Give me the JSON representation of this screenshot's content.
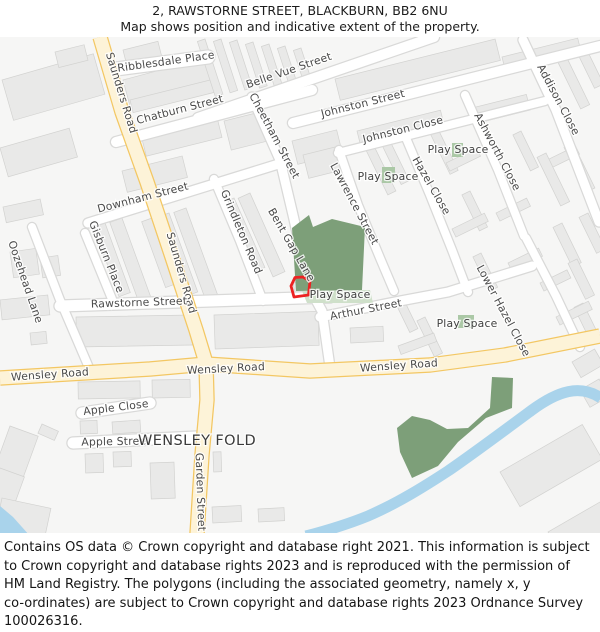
{
  "header": {
    "line1": "2, RAWSTORNE STREET, BLACKBURN, BB2 6NU",
    "line2": "Map shows position and indicative extent of the property."
  },
  "map": {
    "street_labels": [
      {
        "id": "ribblesdale-place",
        "text": "Ribblesdale Place"
      },
      {
        "id": "saunders-road-top",
        "text": "Saunders Road"
      },
      {
        "id": "chatburn-street",
        "text": "Chatburn Street"
      },
      {
        "id": "belle-vue-street",
        "text": "Belle Vue Street"
      },
      {
        "id": "cheetham-street",
        "text": "Cheetham Street"
      },
      {
        "id": "johnston-street",
        "text": "Johnston Street"
      },
      {
        "id": "johnston-close",
        "text": "Johnston Close"
      },
      {
        "id": "addison-close",
        "text": "Addison Close"
      },
      {
        "id": "ashworth-close",
        "text": "Ashworth Close"
      },
      {
        "id": "hazel-close",
        "text": "Hazel Close"
      },
      {
        "id": "play-space-ne",
        "text": "Play Space"
      },
      {
        "id": "play-space-n",
        "text": "Play Space"
      },
      {
        "id": "lawrence-street",
        "text": "Lawrence Street"
      },
      {
        "id": "downham-street",
        "text": "Downham Street"
      },
      {
        "id": "gisburn-place",
        "text": "Gisburn Place"
      },
      {
        "id": "oozehead-lane",
        "text": "Oozehead Lane"
      },
      {
        "id": "saunders-road-mid",
        "text": "Saunders Road"
      },
      {
        "id": "grindleton-road",
        "text": "Grindleton Road"
      },
      {
        "id": "bent-gap-lane",
        "text": "Bent Gap Lane"
      },
      {
        "id": "rawstorne-street",
        "text": "Rawstorne Street"
      },
      {
        "id": "play-space-central",
        "text": "Play Space"
      },
      {
        "id": "arthur-street",
        "text": "Arthur Street"
      },
      {
        "id": "lower-hazel-close",
        "text": "Lower Hazel Close"
      },
      {
        "id": "play-space-se",
        "text": "Play Space"
      },
      {
        "id": "wensley-road-left",
        "text": "Wensley Road"
      },
      {
        "id": "wensley-road-mid",
        "text": "Wensley Road"
      },
      {
        "id": "wensley-road-right",
        "text": "Wensley Road"
      },
      {
        "id": "apple-close",
        "text": "Apple Close"
      },
      {
        "id": "apple-street",
        "text": "Apple Street"
      },
      {
        "id": "wensley-fold-area",
        "text": "WENSLEY FOLD"
      },
      {
        "id": "garden-street",
        "text": "Garden Street"
      }
    ],
    "colors": {
      "background": "#f6f6f5",
      "building": "#e9e9e8",
      "building_border": "#d2d2d0",
      "road_minor": "#ffffff",
      "road_minor_casing": "#d9d9d8",
      "road_major": "#fdf3d8",
      "road_major_casing": "#f3c763",
      "green_space": "#7d9f79",
      "green_light": "#cfe0ca",
      "green_patch": "#abc8a6",
      "water": "#a9d3eb",
      "property_outline": "#ec2222",
      "label_text": "#4a4a4a"
    }
  },
  "footer": {
    "lines": [
      "Contains OS data © Crown copyright and database right 2021. This information is subject",
      "to Crown copyright and database rights 2023 and is reproduced with the permission of",
      "HM Land Registry. The polygons (including the associated geometry, namely x, y",
      "co-ordinates) are subject to Crown copyright and database rights 2023 Ordnance Survey",
      "100026316."
    ]
  }
}
